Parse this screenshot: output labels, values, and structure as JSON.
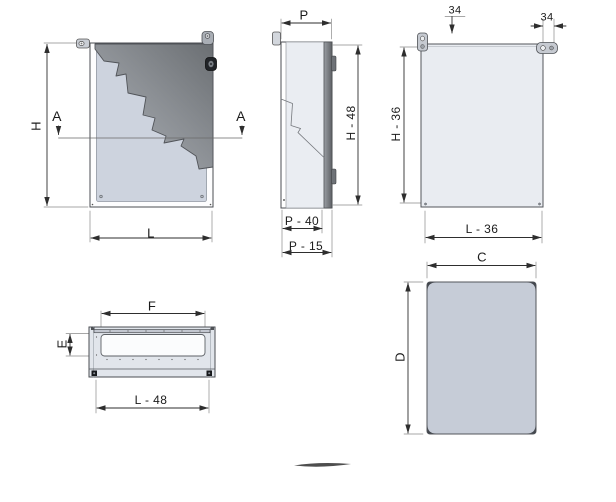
{
  "drawing_title": "Enclosure dimensional drawing",
  "colors": {
    "background": "#ffffff",
    "line": "#2e2e2e",
    "extension_line": "#8a8a8a",
    "panel_light": "#cdd3de",
    "panel_pale": "#eaedf2",
    "panel_medium": "#c6ccd7",
    "door_dark": "#6b6f73"
  },
  "views": {
    "front": {
      "h": "H",
      "l": "L",
      "section_a_left": "A",
      "section_a_right": "A"
    },
    "side": {
      "p": "P",
      "h48": "H - 48",
      "p40": "P - 40",
      "p15": "P - 15"
    },
    "rear": {
      "left34": "34",
      "right34": "34",
      "h36": "H - 36",
      "l36": "L - 36"
    },
    "gland": {
      "f": "F",
      "e": "E",
      "l48": "L - 48"
    },
    "door": {
      "c": "C",
      "d": "D"
    }
  }
}
